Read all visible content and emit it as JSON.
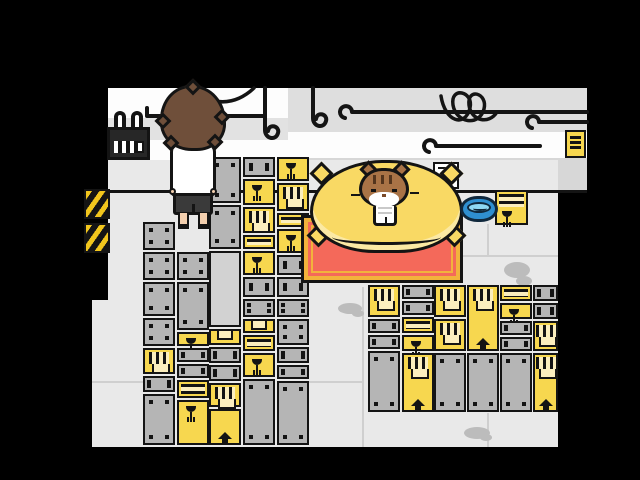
{
  "scene": {
    "description": "Pixel-art game screenshot: warehouse storage room with crate stacks, a player character seen from behind, and a tabby cat sitting on a yellow cushion",
    "canvas": {
      "width": 640,
      "height": 480
    }
  },
  "palette": {
    "ink": "#141414",
    "floor": "#e9e9e9",
    "wallWhite": "#fdfdfd",
    "wallStripe": "#e2e2e2",
    "wallGrayTop": "#dedede",
    "wallGrayLow": "#d7d7d7",
    "crateGray": "#b5b5b5",
    "crateLight": "#d2d2d2",
    "crateYellow": "#f7d74f",
    "crateCream": "#fbeebe",
    "pillow": "#f9d964",
    "pillowShade": "#fbe9a4",
    "matRed": "#f4695a",
    "matTrim": "#f2b33c",
    "bowlBlue": "#2f8fd0",
    "bowlWater": "#8fd8f4",
    "bowlInk": "#10283c",
    "hazardYellow": "#f2c61d",
    "hairBrown": "#6f4f3a",
    "skin": "#f3cfae",
    "shortsDark": "#3a3a3a",
    "catBrown": "#a97346",
    "catDark": "#54351d",
    "stainGray": "#bcbcbc",
    "lineGray": "#cfcfcf"
  },
  "markings_legend": {
    "glass": "fragile-wine-glass-icon",
    "arrow": "this-way-up-arrow-icon",
    "vent": "vent-slats-icon",
    "stripes": "striped-band",
    "bolts": "corner-bolts",
    "pocket": "handle-pocket",
    "slats": "horizontal-slats"
  },
  "entities": {
    "player": {
      "pose": "standing, viewed from behind",
      "hair": "shaggy brown",
      "shirt": "white tee",
      "shorts": "dark"
    },
    "cat": {
      "pose": "sitting upright on cushion facing viewer",
      "fur": "brown tabby with dark forehead stripes, white muzzle and chest"
    },
    "cushion": {
      "shape": "large squashed yellow pillow with corner tufts"
    },
    "mat": {
      "shape": "red rug with yellow-orange double border"
    },
    "bowl": {
      "contents": "water",
      "color": "blue"
    },
    "calendar": {
      "style": "dark wall calendar with two white binder rings and date grid"
    },
    "wall_note": {
      "style": "small yellow paper with black text lines"
    },
    "hazard_signs": [
      {
        "x": 84,
        "y": 189
      },
      {
        "x": 84,
        "y": 223
      }
    ],
    "pipes": "black wall pipes with curled hook ends, two hanging hooks, tangled cable"
  },
  "crates": [
    {
      "x": 143,
      "y": 222,
      "w": 32,
      "h": 28,
      "color": "gray",
      "marks": [
        "bolts"
      ]
    },
    {
      "x": 143,
      "y": 252,
      "w": 32,
      "h": 28,
      "color": "gray",
      "marks": [
        "bolts"
      ]
    },
    {
      "x": 143,
      "y": 282,
      "w": 32,
      "h": 34,
      "color": "gray",
      "marks": [
        "bolts"
      ]
    },
    {
      "x": 143,
      "y": 318,
      "w": 32,
      "h": 28,
      "color": "gray",
      "marks": [
        "bolts"
      ]
    },
    {
      "x": 143,
      "y": 348,
      "w": 32,
      "h": 26,
      "color": "yellow",
      "marks": [
        "vent"
      ]
    },
    {
      "x": 143,
      "y": 376,
      "w": 32,
      "h": 16,
      "color": "gray",
      "marks": [
        "bolts"
      ]
    },
    {
      "x": 143,
      "y": 394,
      "w": 32,
      "h": 51,
      "color": "gray",
      "marks": [
        "bolts"
      ]
    },
    {
      "x": 177,
      "y": 252,
      "w": 32,
      "h": 28,
      "color": "gray",
      "marks": [
        "bolts"
      ]
    },
    {
      "x": 177,
      "y": 282,
      "w": 32,
      "h": 48,
      "color": "gray",
      "marks": [
        "bolts"
      ]
    },
    {
      "x": 177,
      "y": 332,
      "w": 32,
      "h": 14,
      "color": "yellow",
      "marks": [
        "glass"
      ]
    },
    {
      "x": 177,
      "y": 348,
      "w": 32,
      "h": 14,
      "color": "gray",
      "marks": [
        "bolts"
      ]
    },
    {
      "x": 177,
      "y": 364,
      "w": 32,
      "h": 14,
      "color": "gray",
      "marks": [
        "bolts"
      ]
    },
    {
      "x": 177,
      "y": 380,
      "w": 32,
      "h": 18,
      "color": "yellow",
      "marks": [
        "stripes"
      ]
    },
    {
      "x": 177,
      "y": 400,
      "w": 32,
      "h": 45,
      "color": "yellow",
      "marks": [
        "glass"
      ]
    },
    {
      "x": 209,
      "y": 157,
      "w": 32,
      "h": 46,
      "color": "gray",
      "marks": [
        "bolts"
      ]
    },
    {
      "x": 209,
      "y": 205,
      "w": 32,
      "h": 44,
      "color": "gray",
      "marks": [
        "bolts"
      ]
    },
    {
      "x": 209,
      "y": 251,
      "w": 32,
      "h": 76,
      "color": "light",
      "marks": []
    },
    {
      "x": 209,
      "y": 329,
      "w": 32,
      "h": 16,
      "color": "yellow",
      "marks": [
        "pocket"
      ]
    },
    {
      "x": 209,
      "y": 347,
      "w": 32,
      "h": 16,
      "color": "gray",
      "marks": [
        "bolts"
      ]
    },
    {
      "x": 209,
      "y": 365,
      "w": 32,
      "h": 16,
      "color": "gray",
      "marks": [
        "bolts"
      ]
    },
    {
      "x": 209,
      "y": 383,
      "w": 32,
      "h": 24,
      "color": "yellow",
      "marks": [
        "vent"
      ]
    },
    {
      "x": 209,
      "y": 409,
      "w": 32,
      "h": 36,
      "color": "yellow",
      "marks": [
        "arrow"
      ]
    },
    {
      "x": 243,
      "y": 157,
      "w": 32,
      "h": 20,
      "color": "gray",
      "marks": [
        "bolts"
      ]
    },
    {
      "x": 243,
      "y": 179,
      "w": 32,
      "h": 26,
      "color": "yellow",
      "marks": [
        "glass"
      ]
    },
    {
      "x": 243,
      "y": 207,
      "w": 32,
      "h": 26,
      "color": "yellow",
      "marks": [
        "vent"
      ]
    },
    {
      "x": 243,
      "y": 235,
      "w": 32,
      "h": 14,
      "color": "yellow",
      "marks": [
        "stripes"
      ]
    },
    {
      "x": 243,
      "y": 251,
      "w": 32,
      "h": 24,
      "color": "yellow",
      "marks": [
        "glass"
      ]
    },
    {
      "x": 243,
      "y": 277,
      "w": 32,
      "h": 20,
      "color": "gray",
      "marks": [
        "bolts"
      ]
    },
    {
      "x": 243,
      "y": 299,
      "w": 32,
      "h": 18,
      "color": "gray",
      "marks": [
        "bolts"
      ]
    },
    {
      "x": 243,
      "y": 319,
      "w": 32,
      "h": 14,
      "color": "yellow",
      "marks": [
        "pocket"
      ]
    },
    {
      "x": 243,
      "y": 335,
      "w": 32,
      "h": 16,
      "color": "yellow",
      "marks": [
        "stripes"
      ]
    },
    {
      "x": 243,
      "y": 353,
      "w": 32,
      "h": 24,
      "color": "yellow",
      "marks": [
        "glass"
      ]
    },
    {
      "x": 243,
      "y": 379,
      "w": 32,
      "h": 66,
      "color": "gray",
      "marks": [
        "bolts"
      ]
    },
    {
      "x": 277,
      "y": 157,
      "w": 32,
      "h": 24,
      "color": "yellow",
      "marks": [
        "glass"
      ]
    },
    {
      "x": 277,
      "y": 183,
      "w": 32,
      "h": 28,
      "color": "yellow",
      "marks": [
        "vent"
      ]
    },
    {
      "x": 277,
      "y": 213,
      "w": 32,
      "h": 14,
      "color": "yellow",
      "marks": [
        "stripes"
      ]
    },
    {
      "x": 277,
      "y": 229,
      "w": 32,
      "h": 24,
      "color": "yellow",
      "marks": [
        "glass"
      ]
    },
    {
      "x": 277,
      "y": 255,
      "w": 32,
      "h": 20,
      "color": "gray",
      "marks": [
        "bolts"
      ]
    },
    {
      "x": 277,
      "y": 277,
      "w": 32,
      "h": 20,
      "color": "gray",
      "marks": [
        "bolts"
      ]
    },
    {
      "x": 277,
      "y": 299,
      "w": 32,
      "h": 18,
      "color": "gray",
      "marks": [
        "bolts"
      ]
    },
    {
      "x": 277,
      "y": 319,
      "w": 32,
      "h": 26,
      "color": "gray",
      "marks": [
        "bolts"
      ]
    },
    {
      "x": 277,
      "y": 347,
      "w": 32,
      "h": 16,
      "color": "gray",
      "marks": [
        "bolts"
      ]
    },
    {
      "x": 277,
      "y": 365,
      "w": 32,
      "h": 14,
      "color": "gray",
      "marks": [
        "bolts"
      ]
    },
    {
      "x": 277,
      "y": 381,
      "w": 32,
      "h": 64,
      "color": "gray",
      "marks": [
        "bolts"
      ]
    },
    {
      "x": 368,
      "y": 285,
      "w": 32,
      "h": 32,
      "color": "yellow",
      "marks": [
        "vent"
      ]
    },
    {
      "x": 368,
      "y": 319,
      "w": 32,
      "h": 14,
      "color": "gray",
      "marks": [
        "bolts"
      ]
    },
    {
      "x": 368,
      "y": 335,
      "w": 32,
      "h": 14,
      "color": "gray",
      "marks": [
        "bolts"
      ]
    },
    {
      "x": 368,
      "y": 351,
      "w": 32,
      "h": 61,
      "color": "gray",
      "marks": [
        "bolts"
      ]
    },
    {
      "x": 402,
      "y": 285,
      "w": 32,
      "h": 14,
      "color": "gray",
      "marks": [
        "bolts"
      ]
    },
    {
      "x": 402,
      "y": 301,
      "w": 32,
      "h": 14,
      "color": "gray",
      "marks": [
        "bolts"
      ]
    },
    {
      "x": 402,
      "y": 317,
      "w": 32,
      "h": 16,
      "color": "yellow",
      "marks": [
        "stripes"
      ]
    },
    {
      "x": 402,
      "y": 335,
      "w": 32,
      "h": 16,
      "color": "yellow",
      "marks": [
        "glass"
      ]
    },
    {
      "x": 402,
      "y": 353,
      "w": 32,
      "h": 59,
      "color": "yellow",
      "marks": [
        "vent",
        "arrow"
      ]
    },
    {
      "x": 434,
      "y": 285,
      "w": 32,
      "h": 32,
      "color": "yellow",
      "marks": [
        "vent"
      ]
    },
    {
      "x": 434,
      "y": 319,
      "w": 32,
      "h": 32,
      "color": "yellow",
      "marks": [
        "vent"
      ]
    },
    {
      "x": 434,
      "y": 353,
      "w": 32,
      "h": 59,
      "color": "gray",
      "marks": [
        "bolts"
      ]
    },
    {
      "x": 467,
      "y": 285,
      "w": 32,
      "h": 66,
      "color": "yellow",
      "marks": [
        "vent",
        "arrow"
      ]
    },
    {
      "x": 467,
      "y": 353,
      "w": 32,
      "h": 59,
      "color": "gray",
      "marks": [
        "bolts"
      ]
    },
    {
      "x": 500,
      "y": 285,
      "w": 32,
      "h": 16,
      "color": "yellow",
      "marks": [
        "stripes"
      ]
    },
    {
      "x": 500,
      "y": 303,
      "w": 32,
      "h": 16,
      "color": "yellow",
      "marks": [
        "glass"
      ]
    },
    {
      "x": 500,
      "y": 321,
      "w": 32,
      "h": 14,
      "color": "gray",
      "marks": [
        "bolts"
      ]
    },
    {
      "x": 500,
      "y": 337,
      "w": 32,
      "h": 14,
      "color": "gray",
      "marks": [
        "bolts"
      ]
    },
    {
      "x": 500,
      "y": 353,
      "w": 32,
      "h": 59,
      "color": "gray",
      "marks": [
        "bolts"
      ]
    },
    {
      "x": 533,
      "y": 285,
      "w": 25,
      "h": 16,
      "color": "gray",
      "marks": [
        "bolts"
      ]
    },
    {
      "x": 533,
      "y": 303,
      "w": 25,
      "h": 16,
      "color": "gray",
      "marks": [
        "bolts"
      ]
    },
    {
      "x": 533,
      "y": 321,
      "w": 25,
      "h": 30,
      "color": "yellow",
      "marks": [
        "vent"
      ]
    },
    {
      "x": 533,
      "y": 353,
      "w": 25,
      "h": 59,
      "color": "yellow",
      "marks": [
        "vent",
        "arrow"
      ]
    },
    {
      "x": 433,
      "y": 162,
      "w": 26,
      "h": 27,
      "color": "white",
      "marks": [
        "slats"
      ]
    },
    {
      "x": 495,
      "y": 190,
      "w": 33,
      "h": 35,
      "color": "yellow",
      "marks": [
        "stripes-top",
        "glass-low"
      ]
    }
  ],
  "stains": [
    {
      "x": 338,
      "y": 303,
      "w": 24,
      "h": 11
    },
    {
      "x": 352,
      "y": 310,
      "w": 12,
      "h": 7
    },
    {
      "x": 504,
      "y": 262,
      "w": 26,
      "h": 16
    },
    {
      "x": 516,
      "y": 276,
      "w": 16,
      "h": 10
    },
    {
      "x": 464,
      "y": 427,
      "w": 26,
      "h": 12
    },
    {
      "x": 480,
      "y": 434,
      "w": 12,
      "h": 7
    }
  ],
  "floor_lines": [
    {
      "x": 362,
      "y": 287,
      "w": 2,
      "h": 160
    },
    {
      "x": 487,
      "y": 413,
      "w": 2,
      "h": 34
    },
    {
      "x": 487,
      "y": 224,
      "w": 2,
      "h": 31
    },
    {
      "x": 461,
      "y": 255,
      "w": 97,
      "h": 2
    },
    {
      "x": 305,
      "y": 381,
      "w": 59,
      "h": 2
    },
    {
      "x": 92,
      "y": 381,
      "w": 53,
      "h": 2
    }
  ],
  "pipes": [
    {
      "name": "cable-arc",
      "d": "M186,87 Q224,116 254,88",
      "w": 3.5
    },
    {
      "name": "pipe-left",
      "d": "M147,108 l0,8 M147,116 l118,0",
      "w": 4
    },
    {
      "name": "hook-1",
      "d": "M265,88 l0,42 c0,9 11,11 13,3 c2,-7 -9,-10 -10,-2",
      "w": 4
    },
    {
      "name": "hook-2",
      "d": "M313,88 l0,30 c0,9 11,11 13,3 c2,-7 -9,-10 -10,-2",
      "w": 4
    },
    {
      "name": "pipe-right-top",
      "d": "M352,112 a6,6 0 1 0 -7,6 M352,112 L587,112",
      "w": 4
    },
    {
      "name": "pipe-right-mid",
      "d": "M436,146 a6,6 0 1 0 -7,6 M436,146 L540,146",
      "w": 4
    },
    {
      "name": "pipe-right-short",
      "d": "M539,122 a6,6 0 1 0 -7,6 M539,122 L587,122",
      "w": 4
    },
    {
      "name": "cable-tangle",
      "d": "M441,96 c4,26 24,32 29,12 c4,-17 -20,-22 -17,-3 c3,18 26,22 31,4 c4,-16 -17,-22 -15,-4 c2,16 20,20 28,7",
      "w": 3.5
    }
  ]
}
